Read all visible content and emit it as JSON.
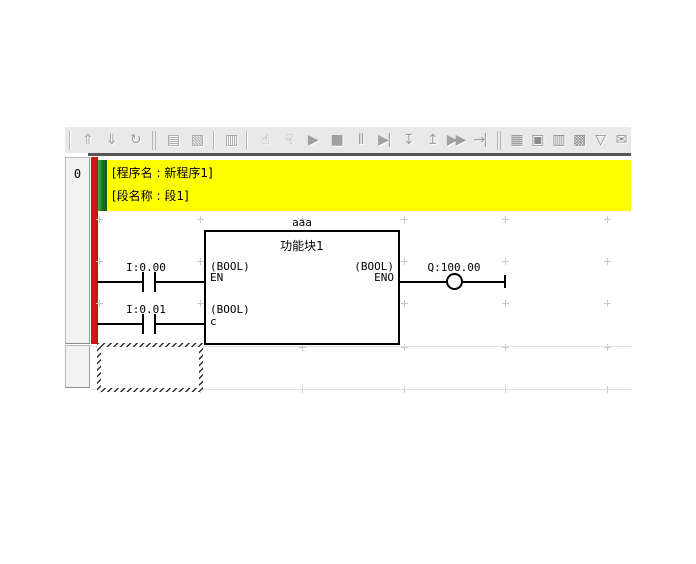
{
  "toolbar": {
    "icons": [
      {
        "name": "upload-program-icon",
        "glyph": "⇑"
      },
      {
        "name": "download-program-icon",
        "glyph": "⇓"
      },
      {
        "name": "compare-program-icon",
        "glyph": "↻"
      },
      {
        "name": "transfer-window-icon",
        "glyph": "▤"
      },
      {
        "name": "transfer-options-icon",
        "glyph": "▧"
      },
      {
        "name": "plc-window-icon",
        "glyph": "▥"
      },
      {
        "name": "work-online-simulator-icon",
        "glyph": "☝"
      },
      {
        "name": "pause-online-icon",
        "glyph": "☟"
      },
      {
        "name": "run-icon",
        "glyph": "▶"
      },
      {
        "name": "stop-icon",
        "glyph": "■"
      },
      {
        "name": "pause-icon",
        "glyph": "Ⅱ"
      },
      {
        "name": "step-run-icon",
        "glyph": "▶|"
      },
      {
        "name": "step-in-icon",
        "glyph": "↧"
      },
      {
        "name": "step-out-icon",
        "glyph": "↥"
      },
      {
        "name": "continuous-step-run-icon",
        "glyph": "▶▶"
      },
      {
        "name": "scan-run-icon",
        "glyph": "→|"
      },
      {
        "name": "io-table-icon",
        "glyph": "▦"
      },
      {
        "name": "plc-settings-icon",
        "glyph": "▣"
      },
      {
        "name": "monitor-window-icon",
        "glyph": "▥"
      },
      {
        "name": "memory-view-icon",
        "glyph": "▩"
      },
      {
        "name": "filter-icon",
        "glyph": "▽"
      },
      {
        "name": "comment-icon",
        "glyph": "✉"
      }
    ]
  },
  "rung_margin": {
    "rung_number": "0"
  },
  "header": {
    "program_line": "[程序名 : 新程序1]",
    "section_line": "[段名称 : 段1]"
  },
  "ladder": {
    "contacts": [
      {
        "label": "I:0.00"
      },
      {
        "label": "I:0.01"
      }
    ],
    "function_block": {
      "instance_name": "aaa",
      "name": "功能块1",
      "inputs": [
        {
          "type": "(BOOL)",
          "name": "EN"
        },
        {
          "type": "(BOOL)",
          "name": "c"
        }
      ],
      "outputs": [
        {
          "type": "(BOOL)",
          "name": "ENO"
        }
      ]
    },
    "coil": {
      "label": "Q:100.00"
    }
  },
  "colors": {
    "left_bus_bar": "#d31515",
    "section_marker": "#147113",
    "header_background": "#ffff00",
    "toolbar_background": "#e9e9e9",
    "grid_cross": "#c9c9c9"
  }
}
